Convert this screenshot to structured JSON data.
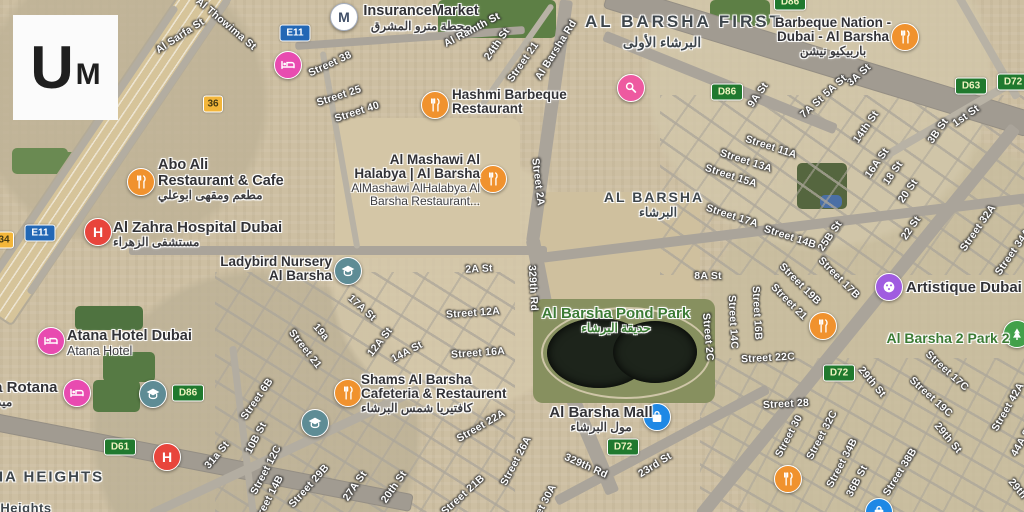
{
  "app": {
    "logo_u": "U",
    "logo_m": "M"
  },
  "map": {
    "icon_colors": {
      "restaurant": "#f0922e",
      "hotel": "#e84bb0",
      "hospital": "#e8453c",
      "school": "#5e8c95",
      "mall": "#1e88e5",
      "beauty": "#ee5aa0",
      "art": "#a05ce0",
      "park": "#42a04a",
      "metro": "#ffffff",
      "park_label_green": "#3c7b35",
      "shield_green": "#20792e",
      "shield_blue": "#2267b5",
      "shield_yellow": "#f3b63a"
    },
    "districts": [
      {
        "t": "AL BARSHA FIRST",
        "x": 684,
        "y": 22,
        "fs": 17,
        "ls": 3
      },
      {
        "t": "البرشاء الأولى",
        "x": 662,
        "y": 43,
        "fs": 13.5,
        "ls": 0
      },
      {
        "t": "AL BARSHA",
        "x": 654,
        "y": 197,
        "fs": 14,
        "ls": 2
      },
      {
        "t": "البرشاء",
        "x": 658,
        "y": 212,
        "fs": 12.5,
        "ls": 0
      },
      {
        "t": "AL BARSHA HEIGHTS",
        "x": 8,
        "y": 477,
        "fs": 15,
        "ls": 2
      },
      {
        "t": "Heights",
        "x": 26,
        "y": 508,
        "fs": 13,
        "ls": 0.5
      }
    ],
    "pois": [
      {
        "id": "insurance-market",
        "icon": "metro",
        "ix": 343,
        "iy": 16,
        "anchor": "center",
        "x": 421,
        "y": 4,
        "lines": [
          [
            "InsuranceMarket",
            "t1",
            14.5
          ],
          [
            "محطة مترو المشرق",
            "ar"
          ]
        ]
      },
      {
        "id": "hashmi-barbeque-restaurant",
        "icon": "restaurant",
        "ix": 434,
        "iy": 104,
        "anchor": "left",
        "x": 452,
        "y": 88,
        "lines": [
          [
            "Hashmi Barbeque",
            "t1"
          ],
          [
            "Restaurant",
            "t1"
          ]
        ]
      },
      {
        "id": "barbeque-nation",
        "icon": "restaurant",
        "ix": 904,
        "iy": 36,
        "anchor": "center",
        "x": 833,
        "y": 16,
        "lines": [
          [
            "Barbeque Nation -",
            "t1"
          ],
          [
            "Dubai - Al Barsha",
            "t1"
          ],
          [
            "باربيكيو نيشن",
            "ar"
          ]
        ]
      },
      {
        "id": "al-mashawi-al-halabya",
        "icon": "restaurant",
        "ix": 492,
        "iy": 178,
        "anchor": "right",
        "x": 480,
        "y": 153,
        "lines": [
          [
            "Al Mashawi Al",
            "t1"
          ],
          [
            "Halabya | Al Barsha",
            "t1"
          ],
          [
            "AlMashawi AlHalabya Al",
            "t2"
          ],
          [
            "Barsha Restaurant...",
            "t2"
          ]
        ]
      },
      {
        "id": "abo-ali-restaurant",
        "icon": "restaurant",
        "ix": 140,
        "iy": 181,
        "anchor": "left",
        "x": 158,
        "y": 158,
        "lines": [
          [
            "Abo Ali",
            "t1",
            14.5
          ],
          [
            "Restaurant & Cafe",
            "t1",
            14.5
          ],
          [
            "مطعم ومقهى ابوعلي",
            "ar"
          ]
        ]
      },
      {
        "id": "al-zahra-hospital",
        "icon": "hospital",
        "ix": 97,
        "iy": 231,
        "anchor": "left",
        "x": 113,
        "y": 220,
        "lines": [
          [
            "Al Zahra Hospital Dubai",
            "t1",
            15
          ],
          [
            "مستشفى الزهراء",
            "ar"
          ]
        ]
      },
      {
        "id": "ladybird-nursery",
        "icon": "school",
        "ix": 347,
        "iy": 270,
        "anchor": "right",
        "x": 332,
        "y": 255,
        "lines": [
          [
            "Ladybird Nursery",
            "t1"
          ],
          [
            "Al Barsha",
            "t1"
          ]
        ]
      },
      {
        "id": "al-barsha-pond-park",
        "icon": null,
        "anchor": "center",
        "x": 616,
        "y": 306,
        "lines": [
          [
            "Al Barsha Pond Park",
            "g1",
            15
          ],
          [
            "حديقة البرشاء",
            "gar"
          ]
        ]
      },
      {
        "id": "al-barsha-mall",
        "icon": "mall",
        "ix": 656,
        "iy": 416,
        "anchor": "center",
        "x": 601,
        "y": 405,
        "lines": [
          [
            "Al Barsha Mall",
            "t1",
            15
          ],
          [
            "مول البرشاء",
            "ar"
          ]
        ]
      },
      {
        "id": "shams-al-barsha",
        "icon": "restaurant",
        "ix": 347,
        "iy": 392,
        "anchor": "left",
        "x": 361,
        "y": 373,
        "lines": [
          [
            "Shams Al Barsha",
            "t1"
          ],
          [
            "Cafeteria & Restaurent",
            "t1"
          ],
          [
            "كافتيريا شمس البرشاء",
            "ar"
          ]
        ]
      },
      {
        "id": "atana-hotel",
        "icon": "hotel",
        "ix": 50,
        "iy": 340,
        "anchor": "left",
        "x": 67,
        "y": 329,
        "lines": [
          [
            "Atana Hotel Dubai",
            "t1",
            14.5
          ],
          [
            "Atana Hotel",
            "t2",
            12.5
          ]
        ]
      },
      {
        "id": "media-rotana",
        "icon": "hotel",
        "ix": 76,
        "iy": 392,
        "anchor": "left",
        "x": -40,
        "y": 380,
        "lines": [
          [
            "Media Rotana",
            "t1",
            15
          ],
          [
            "ميديا روتانا",
            "ar"
          ]
        ]
      },
      {
        "id": "artistique-dubai",
        "icon": "art",
        "ix": 888,
        "iy": 286,
        "anchor": "left",
        "x": 906,
        "y": 280,
        "lines": [
          [
            "Artistique Dubai",
            "t1",
            15
          ]
        ]
      },
      {
        "id": "al-barsha-2-park-2",
        "icon": "park",
        "ix": 1016,
        "iy": 333,
        "anchor": "center",
        "x": 948,
        "y": 331,
        "lines": [
          [
            "Al Barsha 2 Park 2",
            "g1",
            14
          ]
        ]
      }
    ],
    "markers": [
      {
        "icon": "hotel",
        "x": 287,
        "y": 64
      },
      {
        "icon": "beauty",
        "x": 630,
        "y": 87
      },
      {
        "icon": "school",
        "x": 152,
        "y": 393
      },
      {
        "icon": "school",
        "x": 314,
        "y": 422
      },
      {
        "icon": "hospital",
        "x": 166,
        "y": 456
      },
      {
        "icon": "restaurant",
        "x": 822,
        "y": 325
      },
      {
        "icon": "restaurant",
        "x": 787,
        "y": 478
      },
      {
        "icon": "mall",
        "x": 878,
        "y": 511
      }
    ],
    "shields": [
      {
        "t": "E11",
        "type": "blue",
        "x": 295,
        "y": 33
      },
      {
        "t": "E11",
        "type": "blue",
        "x": 40,
        "y": 233
      },
      {
        "t": "36",
        "type": "yellow",
        "x": 213,
        "y": 104
      },
      {
        "t": "34",
        "type": "yellow",
        "x": 4,
        "y": 240
      },
      {
        "t": "D86",
        "type": "green",
        "x": 727,
        "y": 92
      },
      {
        "t": "D86",
        "type": "green",
        "x": 790,
        "y": 2
      },
      {
        "t": "D86",
        "type": "green",
        "x": 188,
        "y": 393
      },
      {
        "t": "D63",
        "type": "green",
        "x": 971,
        "y": 86
      },
      {
        "t": "D72",
        "type": "green",
        "x": 1013,
        "y": 82
      },
      {
        "t": "D72",
        "type": "green",
        "x": 839,
        "y": 373
      },
      {
        "t": "D72",
        "type": "green",
        "x": 623,
        "y": 447
      },
      {
        "t": "D61",
        "type": "green",
        "x": 120,
        "y": 447
      }
    ],
    "streets": [
      [
        "Al Thowima St",
        226,
        24,
        40
      ],
      [
        "Al Sarfa St",
        180,
        36,
        -33
      ],
      [
        "Street 38",
        330,
        64,
        -25
      ],
      [
        "Street 25",
        339,
        96,
        -18
      ],
      [
        "Street 40",
        357,
        112,
        -18
      ],
      [
        "Al Ramth St",
        472,
        30,
        -28
      ],
      [
        "24th St",
        497,
        44,
        -55
      ],
      [
        "Street 21",
        523,
        62,
        -55
      ],
      [
        "Al Barsha Rd",
        556,
        50,
        -58
      ],
      [
        "3A St",
        859,
        75,
        -42
      ],
      [
        "5A St",
        835,
        86,
        -42
      ],
      [
        "7A St",
        812,
        107,
        -42
      ],
      [
        "9A St",
        758,
        95,
        -55
      ],
      [
        "14th St",
        866,
        127,
        -55
      ],
      [
        "1st St",
        966,
        116,
        -35
      ],
      [
        "3B St",
        938,
        131,
        -55
      ],
      [
        "Street 11A",
        771,
        147,
        18
      ],
      [
        "Street 13A",
        746,
        161,
        18
      ],
      [
        "Street 15A",
        731,
        176,
        18
      ],
      [
        "Street 17A",
        732,
        216,
        18
      ],
      [
        "16A St",
        877,
        163,
        -55
      ],
      [
        "18 St",
        893,
        173,
        -55
      ],
      [
        "20 St",
        908,
        191,
        -55
      ],
      [
        "22 St",
        911,
        228,
        -55
      ],
      [
        "Street 32A",
        978,
        228,
        -55
      ],
      [
        "Street 34A",
        1013,
        252,
        -55
      ],
      [
        "Street 14B",
        790,
        237,
        18
      ],
      [
        "25B St",
        830,
        236,
        -55
      ],
      [
        "8A St",
        708,
        276,
        0
      ],
      [
        "Street 2A",
        538,
        182,
        83
      ],
      [
        "329th Rd",
        533,
        288,
        87
      ],
      [
        "2A St",
        479,
        269,
        -3
      ],
      [
        "Street 12A",
        473,
        313,
        -4
      ],
      [
        "Street 16A",
        478,
        353,
        -4
      ],
      [
        "17A St",
        362,
        308,
        42
      ],
      [
        "19a",
        321,
        332,
        48
      ],
      [
        "Street 21",
        305,
        349,
        52
      ],
      [
        "12A St",
        380,
        342,
        -52
      ],
      [
        "14A St",
        407,
        352,
        -28
      ],
      [
        "Street 2C",
        708,
        337,
        85
      ],
      [
        "Street 14C",
        733,
        322,
        87
      ],
      [
        "Street 16B",
        757,
        313,
        87
      ],
      [
        "Street 19B",
        800,
        284,
        45
      ],
      [
        "Street 17B",
        839,
        278,
        45
      ],
      [
        "Street 21",
        789,
        302,
        45
      ],
      [
        "Street 22C",
        768,
        358,
        -3
      ],
      [
        "29th St",
        872,
        382,
        50
      ],
      [
        "Street 28",
        786,
        404,
        -3
      ],
      [
        "Street 30",
        789,
        436,
        -62
      ],
      [
        "Street 32C",
        822,
        435,
        -62
      ],
      [
        "Street 34B",
        842,
        463,
        -62
      ],
      [
        "36B St",
        857,
        481,
        -62
      ],
      [
        "Street 38B",
        900,
        472,
        -58
      ],
      [
        "Street 19C",
        931,
        397,
        42
      ],
      [
        "Street 17C",
        947,
        371,
        42
      ],
      [
        "29th St",
        948,
        438,
        50
      ],
      [
        "Street 42A",
        1008,
        407,
        -60
      ],
      [
        "44A St",
        1022,
        441,
        -60
      ],
      [
        "29th St",
        1022,
        494,
        50
      ],
      [
        "Street 26A",
        516,
        461,
        -62
      ],
      [
        "Street 30A",
        541,
        509,
        -62
      ],
      [
        "329th Rd",
        586,
        466,
        24
      ],
      [
        "23rd St",
        655,
        465,
        -32
      ],
      [
        "Street 6B",
        257,
        399,
        -55
      ],
      [
        "10B St",
        256,
        438,
        -62
      ],
      [
        "Street 12C",
        266,
        470,
        -62
      ],
      [
        "Street 14B",
        268,
        500,
        -62
      ],
      [
        "Street 29B",
        309,
        486,
        -48
      ],
      [
        "27A St",
        355,
        486,
        -55
      ],
      [
        "20th St",
        394,
        487,
        -55
      ],
      [
        "Street 22A",
        481,
        426,
        -30
      ],
      [
        "Street 21B",
        463,
        495,
        -42
      ],
      [
        "31a St",
        217,
        455,
        -50
      ]
    ]
  }
}
